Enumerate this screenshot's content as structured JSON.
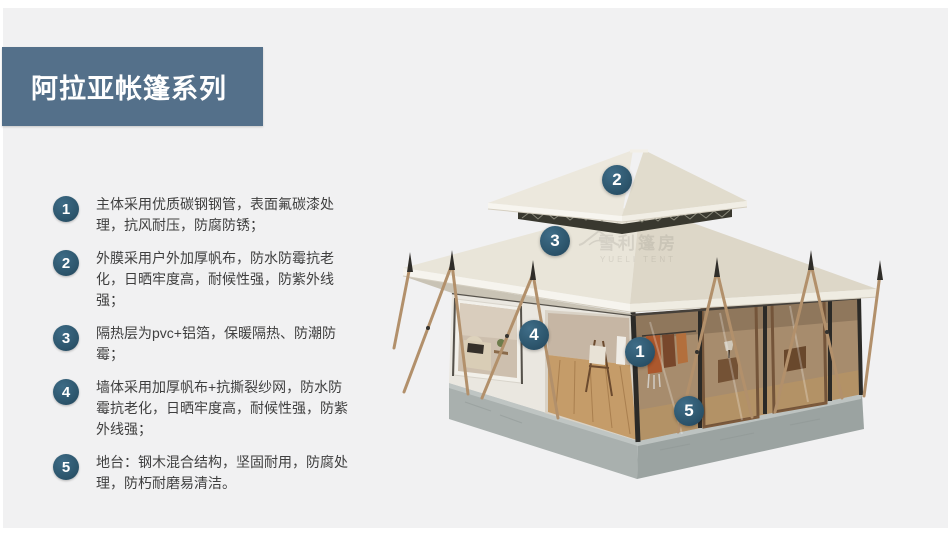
{
  "banner": {
    "title": "阿拉亚帐篷系列"
  },
  "colors": {
    "background": "#f1f1f2",
    "banner": "#54708a",
    "badge": "#2d566d",
    "text": "#3f3f3f"
  },
  "features": [
    {
      "number": "1",
      "text": "主体采用优质碳钢钢管，表面氟碳漆处理，抗风耐压，防腐防锈；"
    },
    {
      "number": "2",
      "text": "外膜采用户外加厚帆布，防水防霉抗老化，日晒牢度高，耐候性强，防紫外线强；"
    },
    {
      "number": "3",
      "text": "隔热层为pvc+铝箔，保暖隔热、防潮防霉；"
    },
    {
      "number": "4",
      "text": "墙体采用加厚帆布+抗撕裂纱网，防水防霉抗老化，日晒牢度高，耐候性强，防紫外线强；"
    },
    {
      "number": "5",
      "text": "地台：钢木混合结构，坚固耐用，防腐处理，防朽耐磨易清洁。"
    }
  ],
  "callouts": [
    {
      "number": "1"
    },
    {
      "number": "2"
    },
    {
      "number": "3"
    },
    {
      "number": "4"
    },
    {
      "number": "5"
    }
  ],
  "watermark": {
    "icon": "tent-icon",
    "text_cn": "雪利篷房",
    "text_en": "YUELI TENT"
  }
}
